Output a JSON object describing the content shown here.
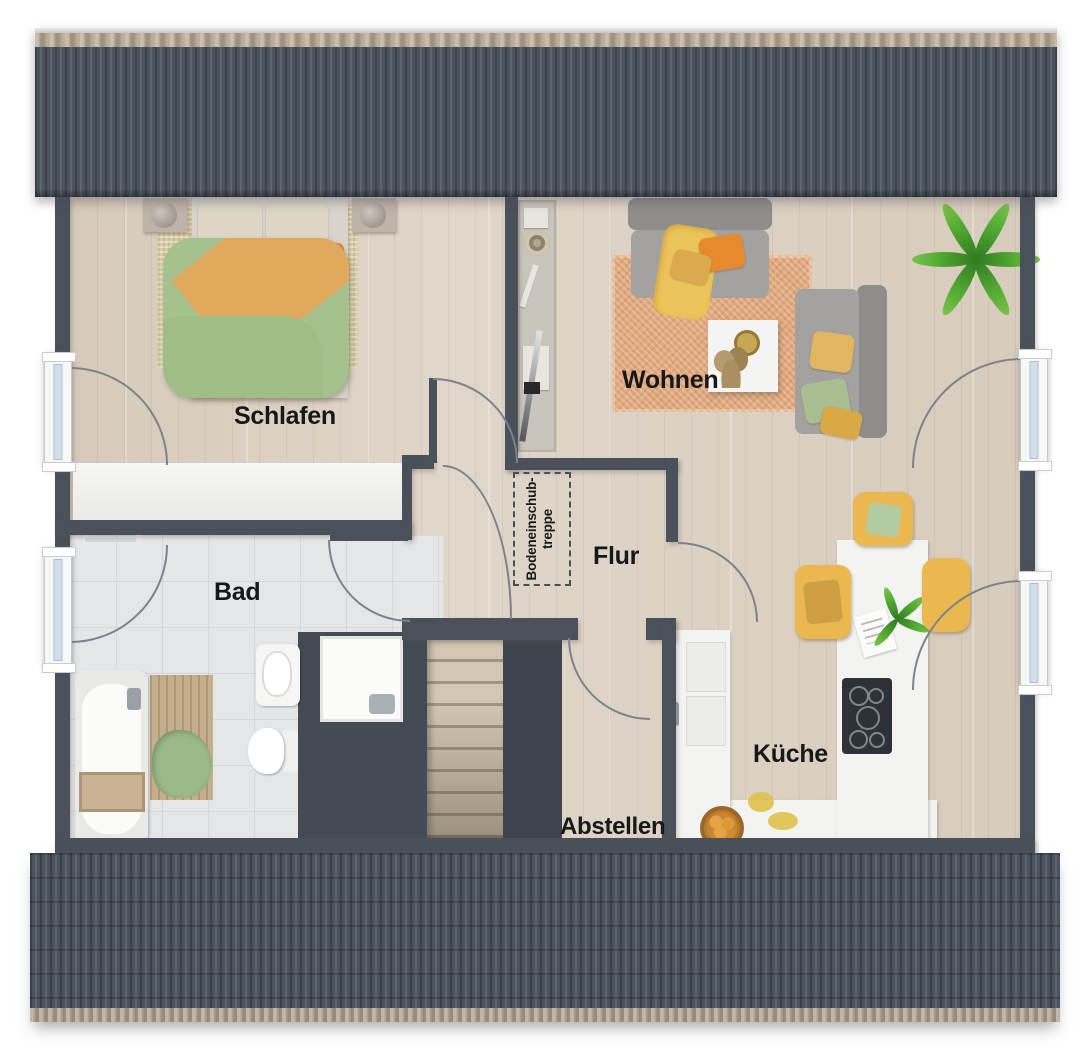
{
  "rooms": {
    "schlafen": {
      "label": "Schlafen"
    },
    "wohnen": {
      "label": "Wohnen"
    },
    "bad": {
      "label": "Bad"
    },
    "flur": {
      "label": "Flur"
    },
    "kueche": {
      "label": "Küche"
    },
    "abstellen": {
      "label": "Abstellen"
    }
  },
  "attic_hatch": {
    "line1": "Bodeneinschub-",
    "line2": "treppe"
  },
  "colors": {
    "wall": "#4a515b",
    "roof": "#4b535e",
    "ridge_tan": "#b1a38d",
    "wood_floor": "#dcd1c3",
    "tile_floor": "#e4e6e8",
    "rug_terracotta": "#e0a87c",
    "rug_beige": "#d8cba6",
    "accent_orange": "#e78a2e",
    "accent_yellow": "#eab84e",
    "accent_green": "#a6c18e",
    "window_glass": "#cfe0ec"
  }
}
